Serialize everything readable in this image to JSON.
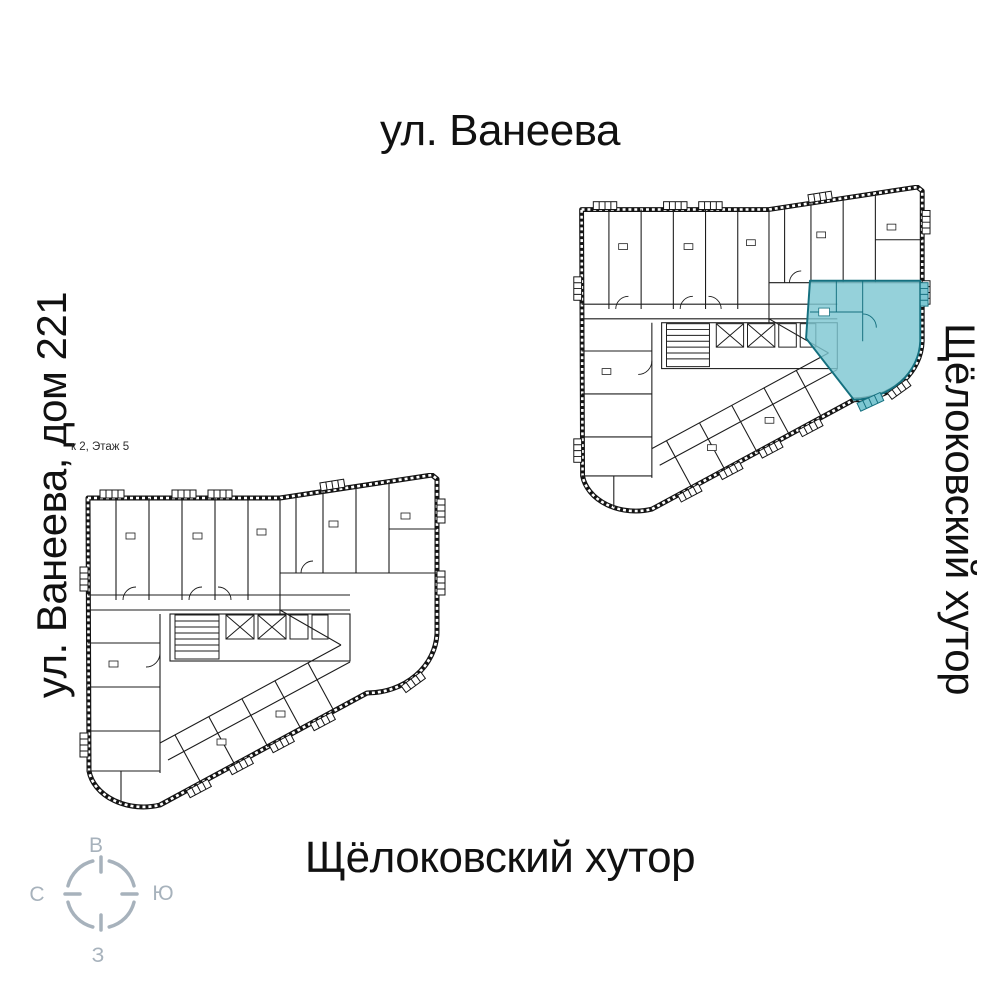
{
  "titles": {
    "top": "ул. Ванеева",
    "bottom": "Щёлоковский хутор",
    "left": "ул. Ванеева, дом 221",
    "right": "Щёлоковский хутор"
  },
  "plan_note": "к 2, Этаж 5",
  "compass": {
    "top": "В",
    "right": "Ю",
    "bottom": "З",
    "left": "С",
    "color": "#a7b2bc"
  },
  "colors": {
    "background": "#ffffff",
    "plan_walls": "#141414",
    "highlight_fill": "#7ec7d2",
    "highlight_outline": "#15707f"
  }
}
